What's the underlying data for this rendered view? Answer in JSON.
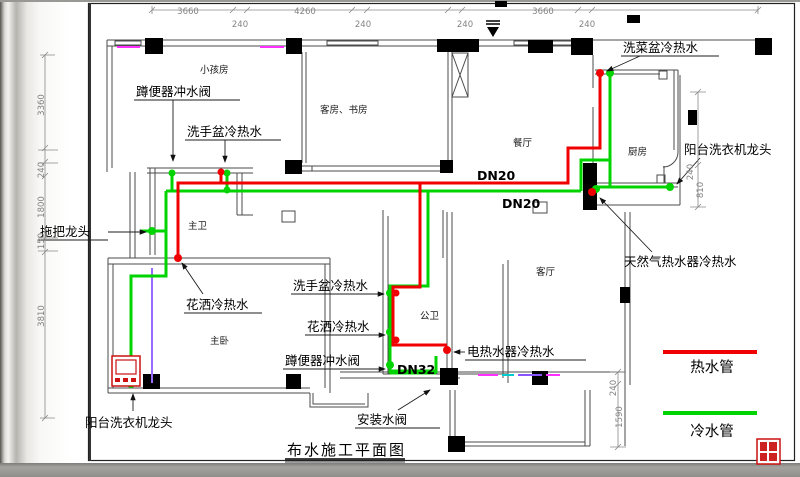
{
  "title": "布水施工平面图",
  "legend": {
    "hot_label": "热水管",
    "hot_color": "#f00000",
    "cold_label": "冷水管",
    "cold_color": "#00d400"
  },
  "pipe_colors": {
    "hot": "#f00000",
    "cold": "#00d400",
    "accent_magenta": "#ff30ff",
    "accent_violet": "#9b6bff",
    "accent_cyan": "#00cccc"
  },
  "rooms": [
    {
      "name": "room-kids",
      "label": "小孩房"
    },
    {
      "name": "room-guest-study",
      "label": "客房、书房"
    },
    {
      "name": "room-dining",
      "label": "餐厅"
    },
    {
      "name": "room-kitchen",
      "label": "厨房"
    },
    {
      "name": "room-master-bath",
      "label": "主卫"
    },
    {
      "name": "room-living",
      "label": "客厅"
    },
    {
      "name": "room-master-bed",
      "label": "主卧"
    },
    {
      "name": "room-public-bath",
      "label": "公卫"
    }
  ],
  "annotations": [
    {
      "name": "squat-toilet-flush-valve-master",
      "label": "蹲便器冲水阀"
    },
    {
      "name": "washbasin-hot-cold-master",
      "label": "洗手盆冷热水"
    },
    {
      "name": "mop-faucet",
      "label": "拖把龙头"
    },
    {
      "name": "shower-hot-cold-master",
      "label": "花洒冷热水"
    },
    {
      "name": "washbasin-hot-cold-public",
      "label": "洗手盆冷热水"
    },
    {
      "name": "shower-hot-cold-public",
      "label": "花洒冷热水"
    },
    {
      "name": "squat-toilet-flush-valve-public",
      "label": "蹲便器冲水阀"
    },
    {
      "name": "kitchen-sink-hot-cold",
      "label": "洗菜盆冷热水"
    },
    {
      "name": "balcony-washer-faucet-right",
      "label": "阳台洗衣机龙头"
    },
    {
      "name": "gas-water-heater-hot-cold",
      "label": "天然气热水器冷热水"
    },
    {
      "name": "electric-water-heater-hot-cold",
      "label": "电热水器冷热水"
    },
    {
      "name": "install-water-valve",
      "label": "安装水阀"
    },
    {
      "name": "balcony-washer-faucet-left",
      "label": "阳台洗衣机龙头"
    }
  ],
  "pipe_size_labels": [
    {
      "label": "DN20"
    },
    {
      "label": "DN20"
    },
    {
      "label": "DN32"
    }
  ],
  "dimensions": {
    "top": [
      {
        "label": "3660"
      },
      {
        "label": "240"
      },
      {
        "label": "4260"
      },
      {
        "label": "240"
      },
      {
        "label": "3660"
      },
      {
        "label": "240"
      },
      {
        "label": "240"
      }
    ],
    "left": [
      {
        "label": "3360"
      },
      {
        "label": "240"
      },
      {
        "label": "1800"
      },
      {
        "label": "150"
      },
      {
        "label": "3810"
      }
    ],
    "right": [
      {
        "label": "240"
      },
      {
        "label": "810"
      },
      {
        "label": "240"
      },
      {
        "label": "1590"
      }
    ]
  }
}
